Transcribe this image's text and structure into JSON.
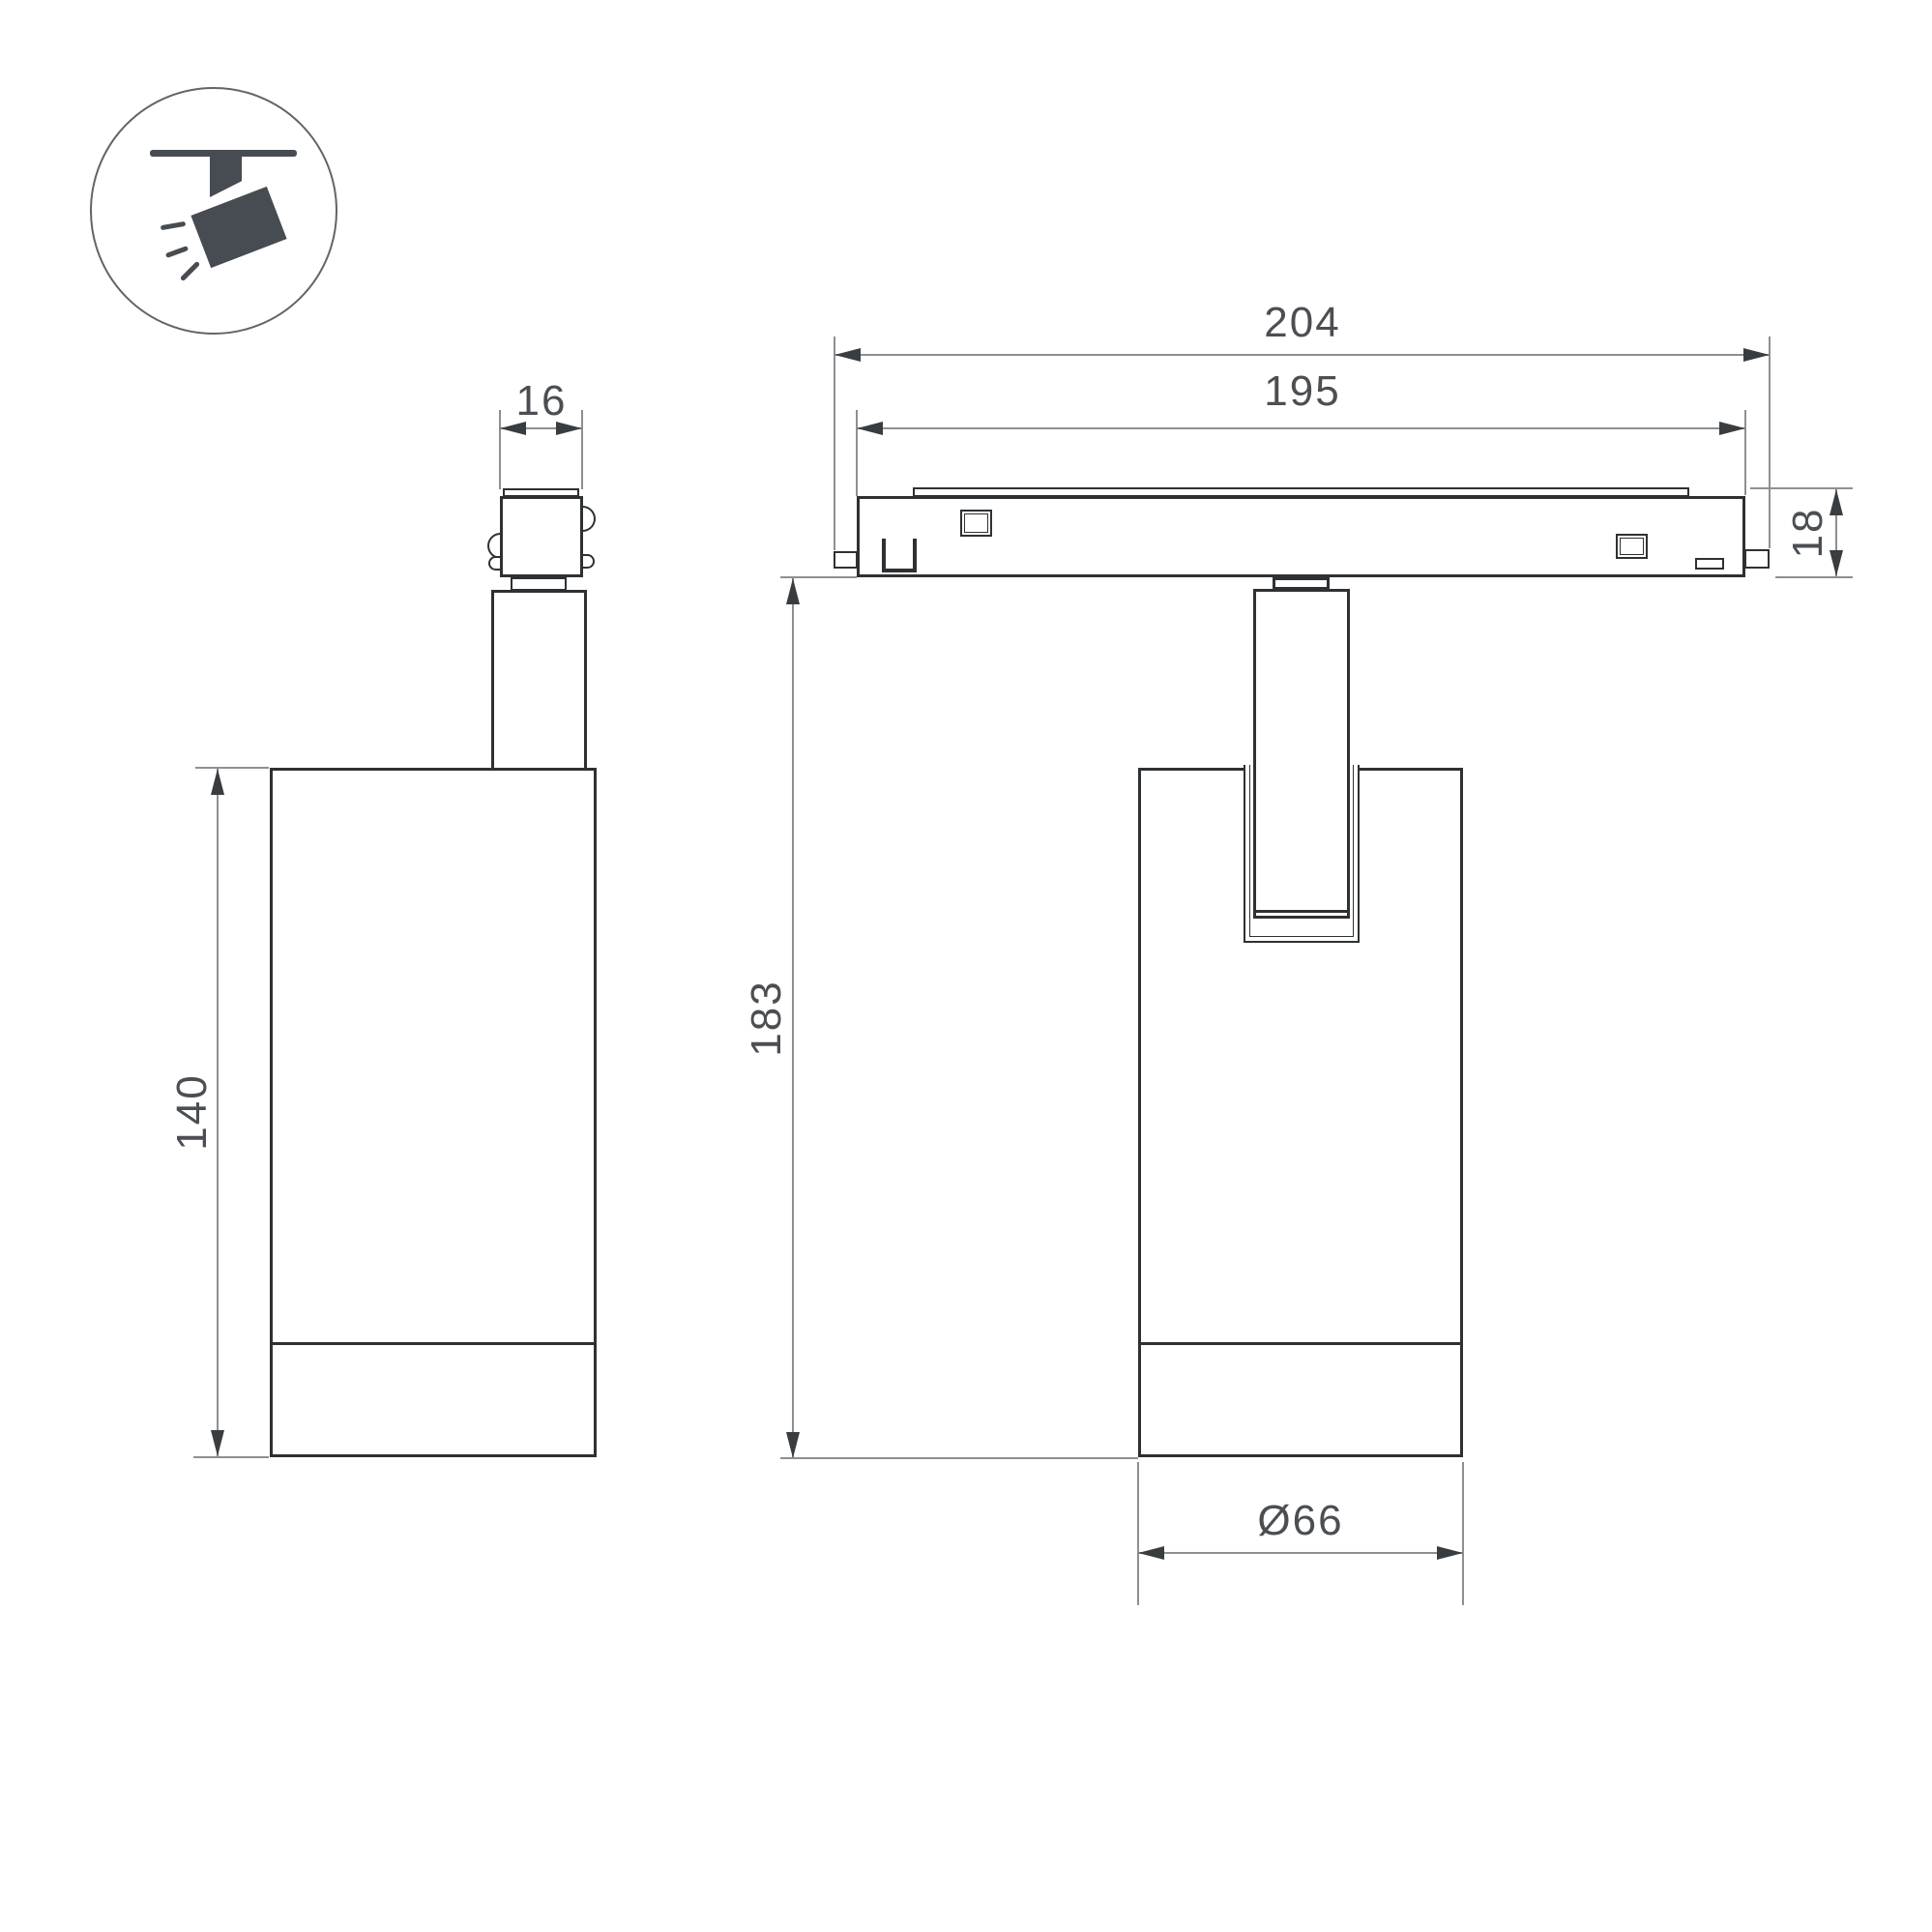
{
  "icon": {
    "name": "ceiling-track-spotlight-pictogram"
  },
  "labels": {
    "adapter_width": "16",
    "body_height": "140",
    "track_length_outer": "204",
    "track_length_inner": "195",
    "track_height": "18",
    "overall_height": "183",
    "body_diameter": "Ø66"
  },
  "colors": {
    "outline": "#2e3133",
    "dimension_line": "#8d9093",
    "arrow": "#3a3d40",
    "text": "#4b4e52",
    "icon": "#474c52",
    "background": "#ffffff"
  }
}
